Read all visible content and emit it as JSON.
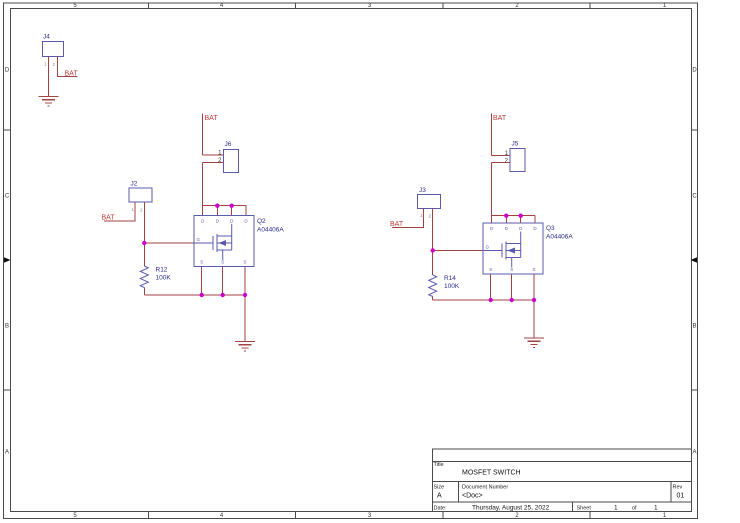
{
  "sheet": {
    "grid": {
      "columns": [
        "5",
        "4",
        "3",
        "2",
        "1"
      ],
      "rows": [
        "D",
        "C",
        "B",
        "A"
      ]
    },
    "title_block": {
      "title_label": "Title",
      "title": "MOSFET SWITCH",
      "size_label": "Size",
      "size": "A",
      "doc_label": "Document Number",
      "doc": "<Doc>",
      "rev_label": "Rev",
      "rev": "01",
      "date_label": "Date:",
      "date": "Thursday, August 25, 2022",
      "sheet_label": "Sheet",
      "sheet_num": "1",
      "of_label": "of",
      "sheet_total": "1"
    }
  },
  "nets": {
    "bat": "BAT"
  },
  "components": {
    "j4": {
      "ref": "J4",
      "pin1": "1",
      "pin2": "2"
    },
    "j2": {
      "ref": "J2",
      "pin1": "1",
      "pin2": "2"
    },
    "j6": {
      "ref": "J6",
      "pin1": "1",
      "pin2": "2"
    },
    "j3": {
      "ref": "J3",
      "pin1": "1",
      "pin2": "2"
    },
    "j5": {
      "ref": "J5",
      "pin1": "1",
      "pin2": "2"
    },
    "q2": {
      "ref": "Q2",
      "value": "A04406A",
      "pin_d": "D",
      "pin_g": "G",
      "pin_s": "S"
    },
    "q3": {
      "ref": "Q3",
      "value": "A04406A",
      "pin_d": "D",
      "pin_g": "G",
      "pin_s": "S"
    },
    "r12": {
      "ref": "R12",
      "value": "100K"
    },
    "r14": {
      "ref": "R14",
      "value": "100K"
    }
  },
  "colors": {
    "wire": "#a34040",
    "symbol": "#5a5aad",
    "refdes": "#2b2b8f",
    "junction": "#cc00cc",
    "net_label": "#c03a3a",
    "border": "#4a4a4a"
  }
}
